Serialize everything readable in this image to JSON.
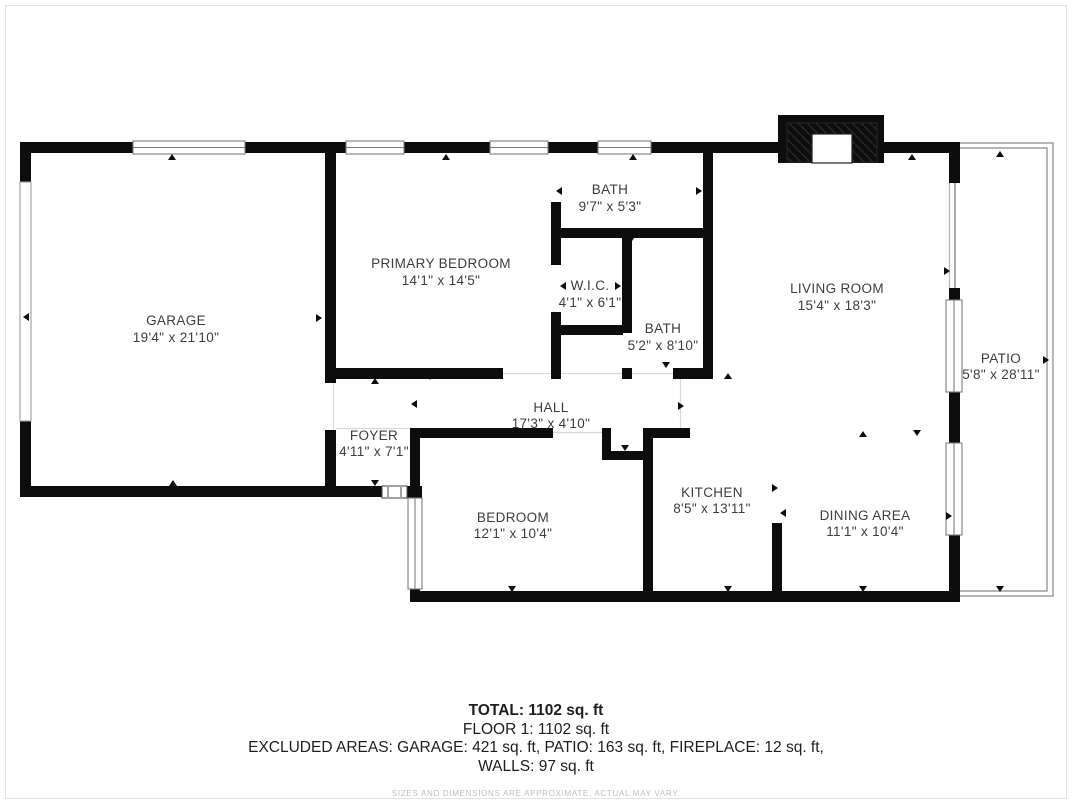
{
  "plan": {
    "rooms": [
      {
        "name": "GARAGE",
        "dims": "19'4\" x 21'10\""
      },
      {
        "name": "PRIMARY BEDROOM",
        "dims": "14'1\" x 14'5\""
      },
      {
        "name": "BATH",
        "dims": "9'7\" x 5'3\""
      },
      {
        "name": "W.I.C.",
        "dims": "4'1\" x 6'1\""
      },
      {
        "name": "BATH",
        "dims": "5'2\" x 8'10\""
      },
      {
        "name": "LIVING ROOM",
        "dims": "15'4\" x 18'3\""
      },
      {
        "name": "PATIO",
        "dims": "5'8\" x 28'11\""
      },
      {
        "name": "FOYER",
        "dims": "4'11\" x 7'1\""
      },
      {
        "name": "HALL",
        "dims": "17'3\" x 4'10\""
      },
      {
        "name": "BEDROOM",
        "dims": "12'1\" x 10'4\""
      },
      {
        "name": "KITCHEN",
        "dims": "8'5\" x 13'11\""
      },
      {
        "name": "DINING AREA",
        "dims": "11'1\" x 10'4\""
      }
    ]
  },
  "summary": {
    "total": "TOTAL: 1102 sq. ft",
    "floor": "FLOOR 1: 1102 sq. ft",
    "excluded": "EXCLUDED AREAS: GARAGE: 421 sq. ft, PATIO: 163 sq. ft, FIREPLACE: 12 sq. ft,",
    "walls": "WALLS: 97 sq. ft",
    "disclaimer": "SIZES AND DIMENSIONS ARE APPROXIMATE, ACTUAL MAY VARY."
  },
  "colors": {
    "wall": "#0d0d0d",
    "label_text": "#3e3e3e",
    "muted_text": "#bfbfbf"
  }
}
